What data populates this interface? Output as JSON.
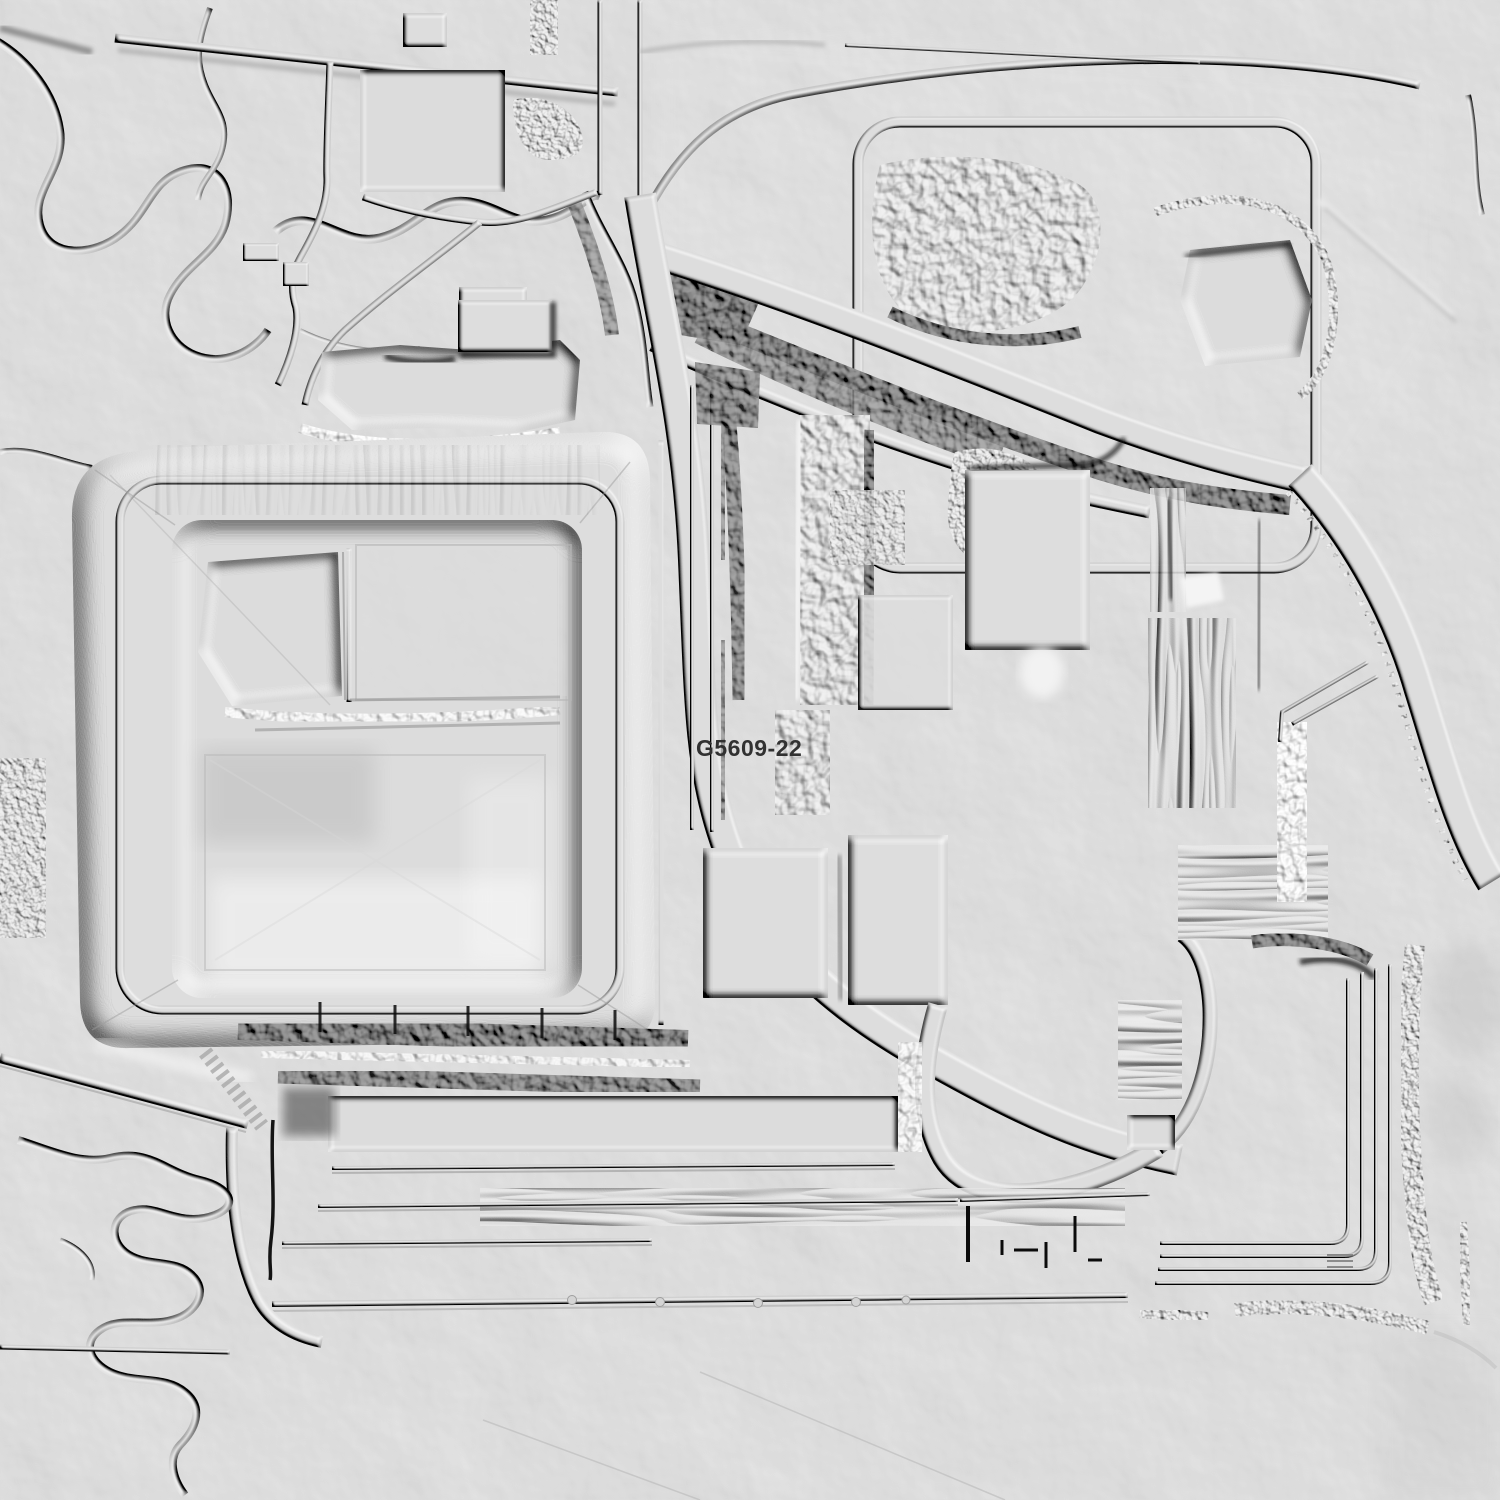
{
  "map": {
    "label": "G5609-22",
    "colors": {
      "base": "#c8c8c8",
      "label": "#313131"
    }
  }
}
